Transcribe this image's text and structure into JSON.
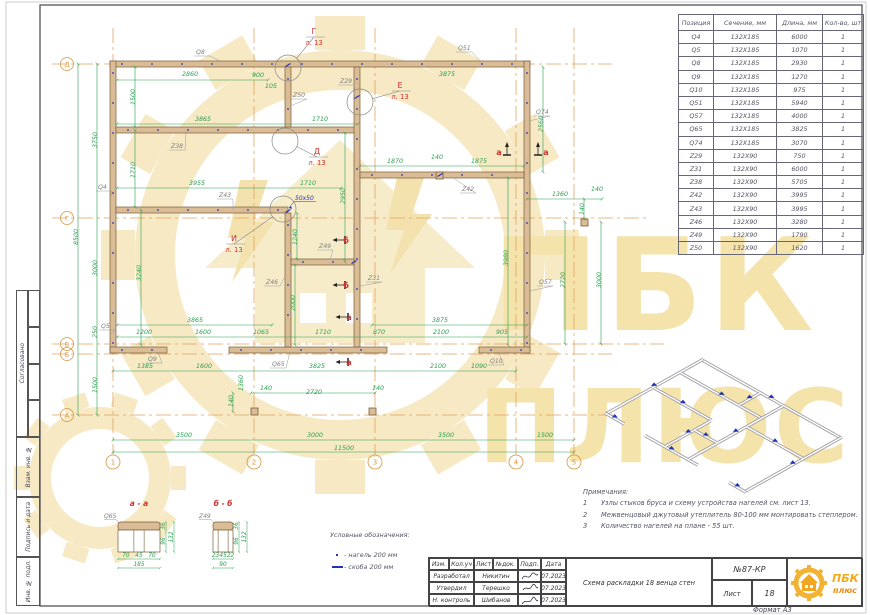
{
  "watermark": {
    "line1": "ПБК",
    "line2": "ПЛЮС",
    "color": "#f6e9c3",
    "text_color": "#f4e3ab"
  },
  "colors": {
    "dim": "#2ba052",
    "axis": "#e3a360",
    "axis_label": "#d9943f",
    "beam": "#dabd96",
    "beam_stroke": "#7a5c36",
    "red": "#d03030",
    "blue": "#2233bb",
    "part": "#808080"
  },
  "table": {
    "headers": [
      "Позиция",
      "Сечение, мм",
      "Длина, мм",
      "Кол-во, шт"
    ],
    "rows": [
      [
        "Q4",
        "132X185",
        "6000",
        "1"
      ],
      [
        "Q5",
        "132X185",
        "1070",
        "1"
      ],
      [
        "Q8",
        "132X185",
        "2930",
        "1"
      ],
      [
        "Q9",
        "132X185",
        "1270",
        "1"
      ],
      [
        "Q10",
        "132X185",
        "975",
        "1"
      ],
      [
        "Q51",
        "132X185",
        "5940",
        "1"
      ],
      [
        "Q57",
        "132X185",
        "4000",
        "1"
      ],
      [
        "Q65",
        "132X185",
        "3825",
        "1"
      ],
      [
        "Q74",
        "132X185",
        "3070",
        "1"
      ],
      [
        "Z29",
        "132X90",
        "750",
        "1"
      ],
      [
        "Z31",
        "132X90",
        "6000",
        "1"
      ],
      [
        "Z38",
        "132X90",
        "5705",
        "1"
      ],
      [
        "Z42",
        "132X90",
        "3995",
        "1"
      ],
      [
        "Z43",
        "132X90",
        "3995",
        "1"
      ],
      [
        "Z46",
        "132X90",
        "3280",
        "1"
      ],
      [
        "Z49",
        "132X90",
        "1790",
        "1"
      ],
      [
        "Z50",
        "132X90",
        "1620",
        "1"
      ]
    ]
  },
  "notes": {
    "title": "Примечания:",
    "items": [
      {
        "num": "1",
        "text": "Узлы стыков бруса и схему устройства нагелей см. лист 13."
      },
      {
        "num": "2",
        "text": "Межвенцовый джутовый утеплитель 80-100 мм монтировать степлером."
      },
      {
        "num": "3",
        "text": "Количество нагелей на плане - 55 шт."
      }
    ]
  },
  "legend": {
    "title": "Условные обозначения:",
    "items": [
      {
        "symbol": "dot",
        "text": "- нагель 200 мм"
      },
      {
        "symbol": "line",
        "text": "- скоба 200 мм"
      }
    ]
  },
  "details": {
    "a": {
      "title": "а - а",
      "part": "Q65",
      "x": 118,
      "w": 42,
      "splits": [
        0.378,
        0.622
      ],
      "bottom": [
        "70",
        "45",
        "70"
      ],
      "total": "185",
      "right": [
        "36",
        "96",
        "132"
      ]
    },
    "b": {
      "title": "б - б",
      "part": "Z49",
      "x": 213,
      "w": 20,
      "splits": [
        0.256,
        0.756
      ],
      "bottom": [
        "23",
        "45",
        "22"
      ],
      "total": "90",
      "right": [
        "36",
        "96",
        "132"
      ]
    }
  },
  "title_block": {
    "header_cols": [
      "Изм.",
      "Кол.уч",
      "Лист",
      "№док.",
      "Подп.",
      "Дата"
    ],
    "rows": [
      {
        "role": "Разработал",
        "name": "Никитин",
        "date": "07.2023"
      },
      {
        "role": "Утвердил",
        "name": "Терешко",
        "date": "07.2023"
      },
      {
        "role": "Н. контроль",
        "name": "Шибанов",
        "date": "07.2023"
      }
    ],
    "doc_number": "№87-КР",
    "title": "Схема раскладки 18 венца стен",
    "sheet_label": "Лист",
    "sheet_number": "18",
    "format": "Формат А3",
    "logo_top": "ПБК",
    "logo_bottom": "плюс"
  },
  "side_strip": {
    "labels": [
      "Согласовано",
      "Взам. инв. №",
      "Подпись и дата",
      "Инв. № подл."
    ]
  },
  "plan": {
    "col_axes": [
      {
        "label": "1",
        "x": 113
      },
      {
        "label": "2",
        "x": 254
      },
      {
        "label": "3",
        "x": 375
      },
      {
        "label": "4",
        "x": 516
      },
      {
        "label": "5",
        "x": 574
      }
    ],
    "row_axes": [
      {
        "label": "Д",
        "y": 64,
        "x2": 612
      },
      {
        "label": "Г",
        "y": 218,
        "x2": 650
      },
      {
        "label": "В",
        "y": 344,
        "x2": 664
      },
      {
        "label": "Б",
        "y": 354,
        "x2": 612
      },
      {
        "label": "А",
        "y": 415,
        "x2": 615
      }
    ],
    "walls": [
      {
        "x": 110,
        "y": 61,
        "w": 420,
        "h": 6
      },
      {
        "x": 110,
        "y": 61,
        "w": 6,
        "h": 292
      },
      {
        "x": 524,
        "y": 61,
        "w": 6,
        "h": 292
      },
      {
        "x": 110,
        "y": 347,
        "w": 57,
        "h": 6
      },
      {
        "x": 229,
        "y": 347,
        "w": 158,
        "h": 6
      },
      {
        "x": 479,
        "y": 347,
        "w": 51,
        "h": 6
      },
      {
        "x": 116,
        "y": 127,
        "w": 243,
        "h": 6
      },
      {
        "x": 285,
        "y": 67,
        "w": 6,
        "h": 60
      },
      {
        "x": 354,
        "y": 67,
        "w": 6,
        "h": 280
      },
      {
        "x": 360,
        "y": 172,
        "w": 164,
        "h": 6
      },
      {
        "x": 116,
        "y": 207,
        "w": 172,
        "h": 6
      },
      {
        "x": 285,
        "y": 213,
        "w": 6,
        "h": 134
      },
      {
        "x": 291,
        "y": 259,
        "w": 63,
        "h": 6
      }
    ],
    "posts": [
      {
        "x": 581,
        "y": 219
      },
      {
        "x": 251,
        "y": 408
      },
      {
        "x": 369,
        "y": 408
      },
      {
        "x": 436,
        "y": 172
      }
    ],
    "dims": [
      {
        "t": "2860",
        "x": 190,
        "y": 76
      },
      {
        "t": "900",
        "x": 258,
        "y": 77
      },
      {
        "t": "105",
        "x": 271,
        "y": 88
      },
      {
        "t": "3875",
        "x": 447,
        "y": 76
      },
      {
        "t": "3865",
        "x": 203,
        "y": 121
      },
      {
        "t": "1710",
        "x": 320,
        "y": 121
      },
      {
        "t": "1870",
        "x": 395,
        "y": 163
      },
      {
        "t": "140",
        "x": 437,
        "y": 159
      },
      {
        "t": "1875",
        "x": 479,
        "y": 163
      },
      {
        "t": "3955",
        "x": 197,
        "y": 185
      },
      {
        "t": "1710",
        "x": 308,
        "y": 185
      },
      {
        "t": "1360",
        "x": 560,
        "y": 196
      },
      {
        "t": "140",
        "x": 597,
        "y": 191
      },
      {
        "t": "3865",
        "x": 195,
        "y": 322
      },
      {
        "t": "3875",
        "x": 440,
        "y": 322
      },
      {
        "t": "1200",
        "x": 144,
        "y": 334
      },
      {
        "t": "1600",
        "x": 203,
        "y": 334
      },
      {
        "t": "1065",
        "x": 261,
        "y": 334
      },
      {
        "t": "1710",
        "x": 323,
        "y": 334
      },
      {
        "t": "870",
        "x": 379,
        "y": 334
      },
      {
        "t": "2100",
        "x": 441,
        "y": 334
      },
      {
        "t": "905",
        "x": 502,
        "y": 334
      },
      {
        "t": "1385",
        "x": 145,
        "y": 368
      },
      {
        "t": "1600",
        "x": 204,
        "y": 368
      },
      {
        "t": "3825",
        "x": 317,
        "y": 368
      },
      {
        "t": "2100",
        "x": 438,
        "y": 368
      },
      {
        "t": "1090",
        "x": 479,
        "y": 368
      },
      {
        "t": "140",
        "x": 266,
        "y": 390
      },
      {
        "t": "2720",
        "x": 314,
        "y": 394
      },
      {
        "t": "140",
        "x": 378,
        "y": 390
      },
      {
        "t": "3500",
        "x": 184,
        "y": 437
      },
      {
        "t": "3000",
        "x": 315,
        "y": 437
      },
      {
        "t": "3500",
        "x": 446,
        "y": 437
      },
      {
        "t": "1500",
        "x": 545,
        "y": 437
      },
      {
        "t": "11500",
        "x": 344,
        "y": 450
      },
      {
        "t": "3750",
        "x": 97,
        "y": 140,
        "r": 1
      },
      {
        "t": "3000",
        "x": 97,
        "y": 268,
        "r": 1
      },
      {
        "t": "250",
        "x": 97,
        "y": 332,
        "r": 1
      },
      {
        "t": "1500",
        "x": 97,
        "y": 385,
        "r": 1
      },
      {
        "t": "8500",
        "x": 78,
        "y": 237,
        "r": 1
      },
      {
        "t": "1500",
        "x": 135,
        "y": 97,
        "r": 1
      },
      {
        "t": "1710",
        "x": 135,
        "y": 170,
        "r": 1
      },
      {
        "t": "3240",
        "x": 141,
        "y": 273,
        "r": 1
      },
      {
        "t": "2950",
        "x": 345,
        "y": 196,
        "r": 1
      },
      {
        "t": "1240",
        "x": 297,
        "y": 237,
        "r": 1
      },
      {
        "t": "2000",
        "x": 295,
        "y": 303,
        "r": 1
      },
      {
        "t": "2560",
        "x": 543,
        "y": 124,
        "r": 1
      },
      {
        "t": "3980",
        "x": 508,
        "y": 258,
        "r": 1
      },
      {
        "t": "2720",
        "x": 565,
        "y": 280,
        "r": 1
      },
      {
        "t": "3000",
        "x": 601,
        "y": 280,
        "r": 1
      },
      {
        "t": "140",
        "x": 233,
        "y": 401,
        "r": 1
      },
      {
        "t": "140",
        "x": 584,
        "y": 209,
        "r": 1
      },
      {
        "t": "1360",
        "x": 243,
        "y": 383,
        "r": 1
      }
    ],
    "dim_lines": {
      "h": [
        [
          117,
          268,
          80
        ],
        [
          117,
          358,
          124
        ],
        [
          360,
          524,
          166
        ],
        [
          117,
          341,
          188
        ],
        [
          527,
          602,
          199
        ],
        [
          117,
          272,
          325
        ],
        [
          372,
          527,
          325
        ],
        [
          117,
          527,
          337
        ],
        [
          113,
          516,
          371
        ],
        [
          251,
          375,
          393
        ],
        [
          113,
          574,
          440
        ],
        [
          113,
          574,
          452
        ]
      ],
      "v": [
        [
          97,
          64,
          415
        ],
        [
          78,
          64,
          415
        ],
        [
          135,
          67,
          127
        ],
        [
          135,
          130,
          207
        ],
        [
          141,
          210,
          345
        ],
        [
          345,
          133,
          262
        ],
        [
          297,
          213,
          259
        ],
        [
          295,
          265,
          345
        ],
        [
          543,
          67,
          172
        ],
        [
          508,
          178,
          345
        ],
        [
          565,
          222,
          344
        ],
        [
          601,
          222,
          344
        ],
        [
          233,
          393,
          412
        ],
        [
          584,
          199,
          219
        ]
      ]
    },
    "part_labels": [
      {
        "t": "Q8",
        "x": 196,
        "y": 54,
        "lx": 222,
        "ly": 62
      },
      {
        "t": "Q51",
        "x": 458,
        "y": 50,
        "lx": 480,
        "ly": 61
      },
      {
        "t": "Q4",
        "x": 98,
        "y": 189,
        "lx": 111,
        "ly": 196
      },
      {
        "t": "Q5",
        "x": 101,
        "y": 328,
        "lx": 111,
        "ly": 334
      },
      {
        "t": "Q9",
        "x": 148,
        "y": 361,
        "lx": 158,
        "ly": 352
      },
      {
        "t": "Q65",
        "x": 272,
        "y": 366,
        "lx": 290,
        "ly": 352
      },
      {
        "t": "Q10",
        "x": 490,
        "y": 363,
        "lx": 498,
        "ly": 352
      },
      {
        "t": "Q74",
        "x": 536,
        "y": 114,
        "lx": 529,
        "ly": 121
      },
      {
        "t": "Q57",
        "x": 539,
        "y": 284,
        "lx": 529,
        "ly": 291
      },
      {
        "t": "Z38",
        "x": 171,
        "y": 148,
        "lx": 186,
        "ly": 132
      },
      {
        "t": "Z50",
        "x": 293,
        "y": 97,
        "lx": 290,
        "ly": 106
      },
      {
        "t": "Z29",
        "x": 340,
        "y": 83,
        "lx": 355,
        "ly": 90
      },
      {
        "t": "Z42",
        "x": 462,
        "y": 191,
        "lx": 452,
        "ly": 177
      },
      {
        "t": "Z43",
        "x": 219,
        "y": 197,
        "lx": 233,
        "ly": 209
      },
      {
        "t": "Z46",
        "x": 266,
        "y": 284,
        "lx": 284,
        "ly": 278
      },
      {
        "t": "Z49",
        "x": 319,
        "y": 248,
        "lx": 330,
        "ly": 260
      },
      {
        "t": "Z31",
        "x": 368,
        "y": 280,
        "lx": 360,
        "ly": 286
      }
    ],
    "node_labels": [
      {
        "t": "Г",
        "sub": "л. 13",
        "x": 310,
        "y": 33,
        "cx": 288,
        "cy": 68
      },
      {
        "t": "Е",
        "sub": "л. 13",
        "x": 396,
        "y": 87,
        "cx": 360,
        "cy": 102
      },
      {
        "t": "Д",
        "sub": "л. 13",
        "x": 313,
        "y": 153,
        "cx": 285,
        "cy": 141
      },
      {
        "t": "И",
        "sub": "л. 13",
        "x": 230,
        "y": 240,
        "cx": 283,
        "cy": 209
      }
    ],
    "section_marks": [
      {
        "t": "а",
        "x": 499,
        "y": 155,
        "ax": 507,
        "ay": 155,
        "dir": "up"
      },
      {
        "t": "а",
        "x": 546,
        "y": 155,
        "ax": 538,
        "ay": 155,
        "dir": "up"
      },
      {
        "t": "а",
        "x": 349,
        "y": 320,
        "ax": 339,
        "ay": 317,
        "dir": "left"
      },
      {
        "t": "а",
        "x": 349,
        "y": 365,
        "ax": 339,
        "ay": 362,
        "dir": "left"
      },
      {
        "t": "б",
        "x": 346,
        "y": 243,
        "ax": 336,
        "ay": 240,
        "dir": "left"
      },
      {
        "t": "б",
        "x": 346,
        "y": 288,
        "ax": 336,
        "ay": 285,
        "dir": "left"
      }
    ],
    "callouts": [
      {
        "t": "50х50",
        "x": 295,
        "y": 200,
        "tx": 289,
        "ty": 208
      }
    ]
  }
}
